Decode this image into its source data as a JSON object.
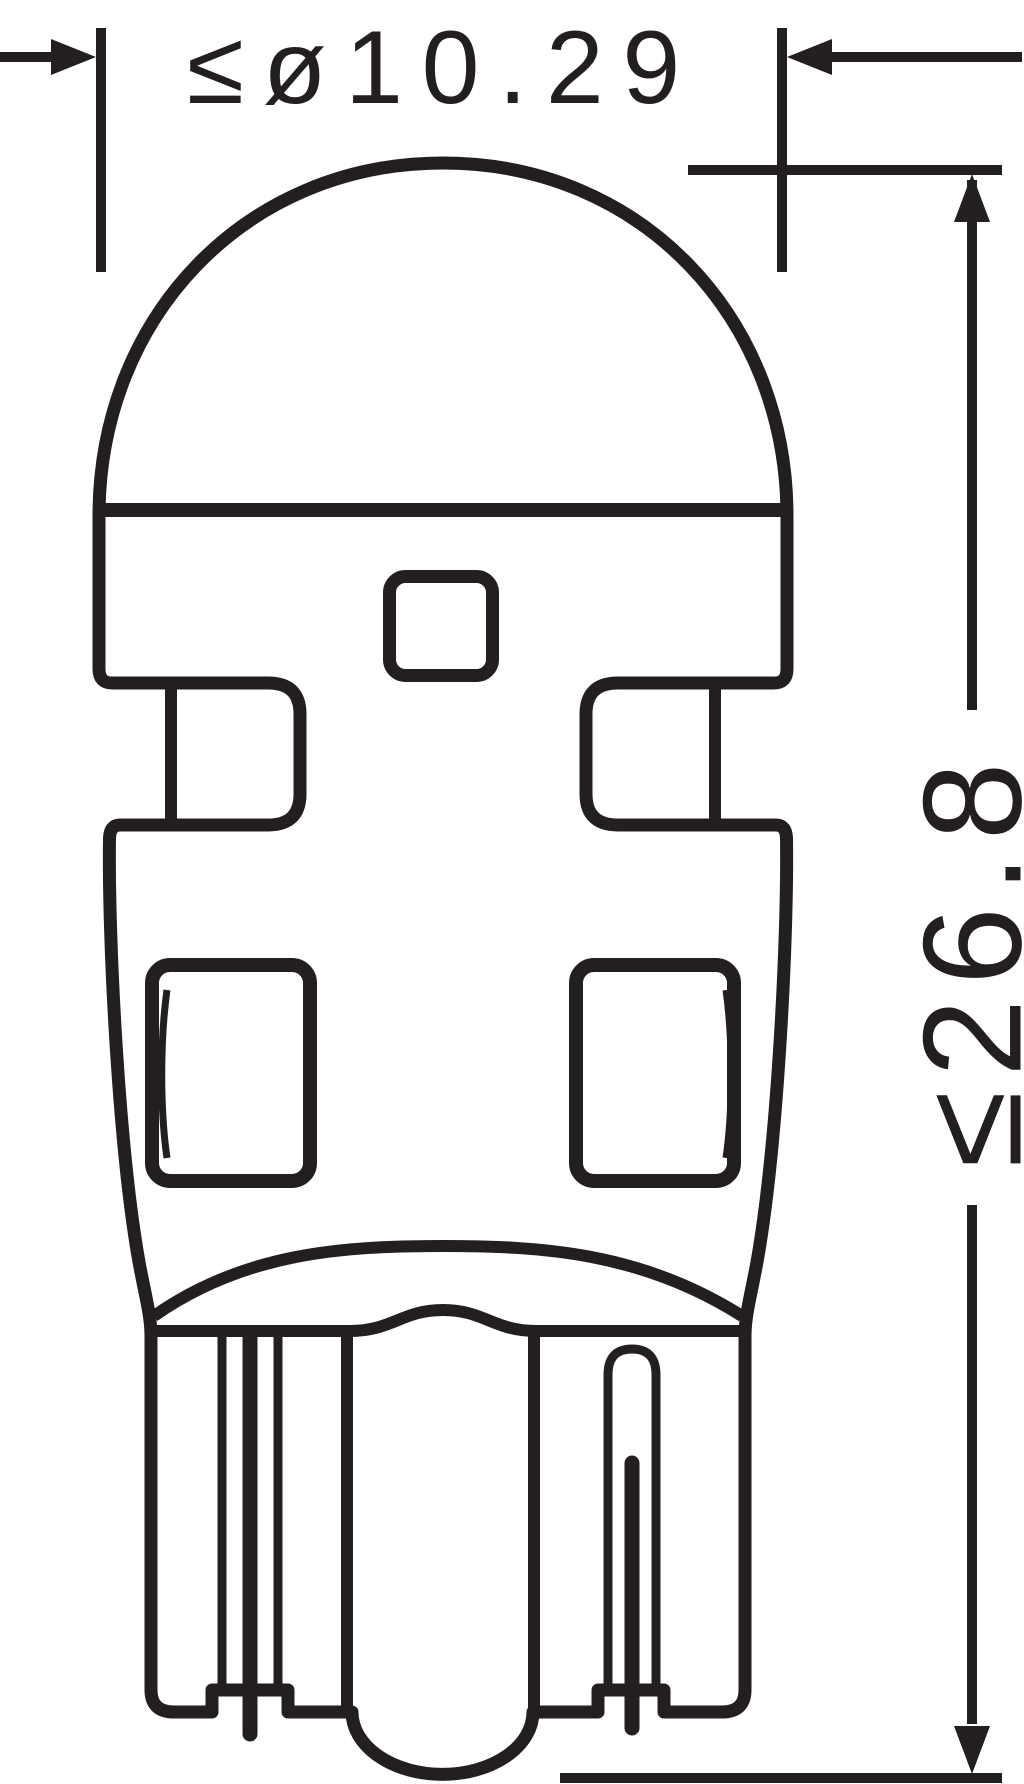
{
  "colors": {
    "ink": "#231f20",
    "background": "#ffffff"
  },
  "dimensions": {
    "diameter": {
      "label": "≤ø10.29",
      "value": 10.29,
      "constraint": "max"
    },
    "length": {
      "label": "≤26.8",
      "value": 26.8,
      "constraint": "max"
    }
  }
}
